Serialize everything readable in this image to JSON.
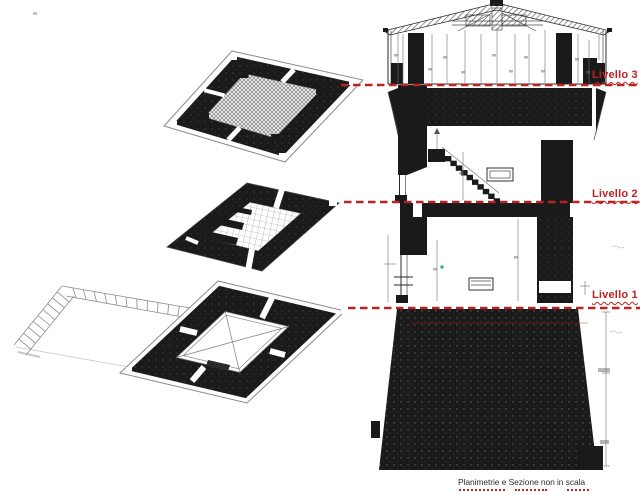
{
  "canvas": {
    "width": 640,
    "height": 495,
    "background": "#ffffff"
  },
  "colors": {
    "ink": "#1a1a1a",
    "pencil": "#6f6f6f",
    "accent_red": "#bb2420",
    "teal_mark": "#3fae9e",
    "caption_text": "#2f2f2f"
  },
  "figures": [
    {
      "name": "floor-plan-level-3"
    },
    {
      "name": "floor-plan-level-2"
    },
    {
      "name": "floor-plan-level-1-with-access-ramp"
    },
    {
      "name": "tower-cross-section"
    }
  ],
  "levels": [
    {
      "id": "livello-3",
      "label": "Livello 3"
    },
    {
      "id": "livello-2",
      "label": "Livello 2"
    },
    {
      "id": "livello-1",
      "label": "Livello 1"
    }
  ],
  "footer": {
    "note": "Planimetrie e Sezione non in scala"
  }
}
